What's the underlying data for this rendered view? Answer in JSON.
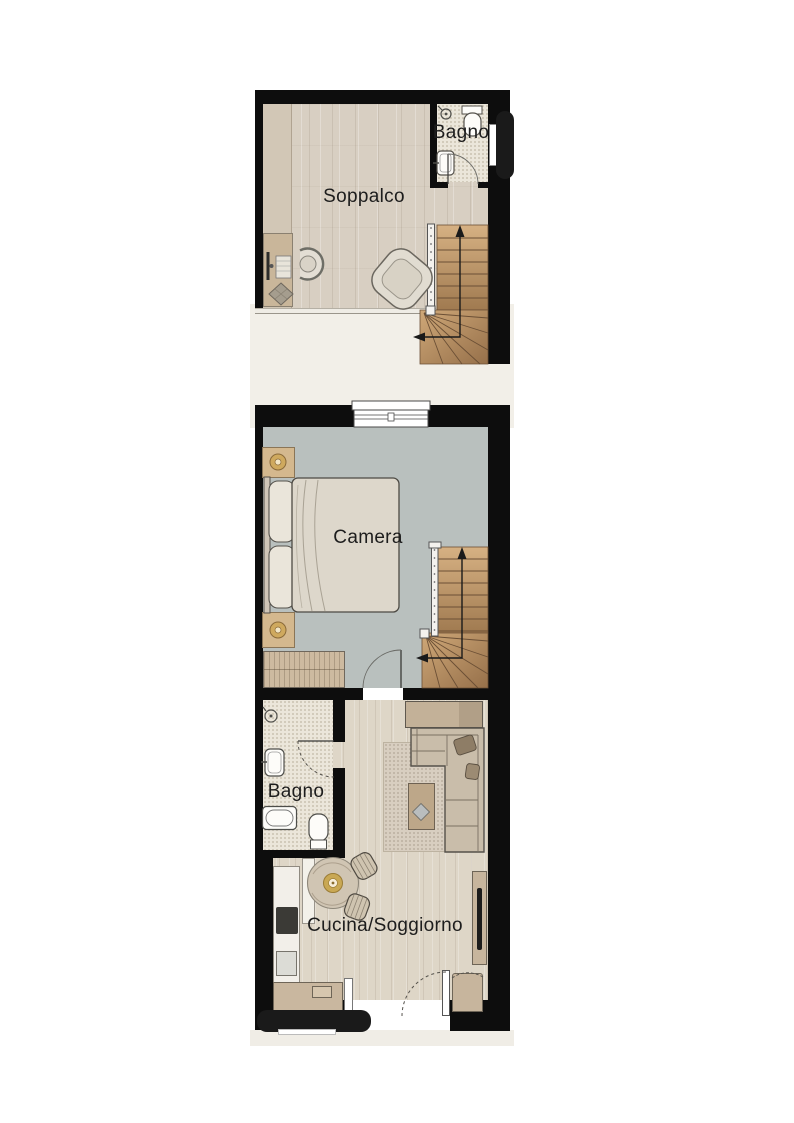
{
  "plan": {
    "title": "apartment floor plan",
    "rooms": [
      {
        "id": "soppalco",
        "label": "Soppalco"
      },
      {
        "id": "bagno_top",
        "label": "Bagno"
      },
      {
        "id": "camera",
        "label": "Camera"
      },
      {
        "id": "bagno_lower",
        "label": "Bagno"
      },
      {
        "id": "cucina_soggiorno",
        "label": "Cucina/Soggiorno"
      }
    ],
    "symbols": [
      {
        "id": "stair_arrow_upper",
        "meaning": "stair direction arrow"
      },
      {
        "id": "stair_arrow_lower",
        "meaning": "stair direction arrow"
      }
    ],
    "colors": {
      "wall": "#0d0d0d",
      "wood_floor_upper": "#d8cfc2",
      "wood_floor_lower": "#ded6c7",
      "camera_floor": "#b9c0be",
      "bath_floor": "#ebe6da",
      "stair_wood": "#c79e6f",
      "void_background": "#f2efe8",
      "label_text": "#1d1d1d"
    }
  }
}
